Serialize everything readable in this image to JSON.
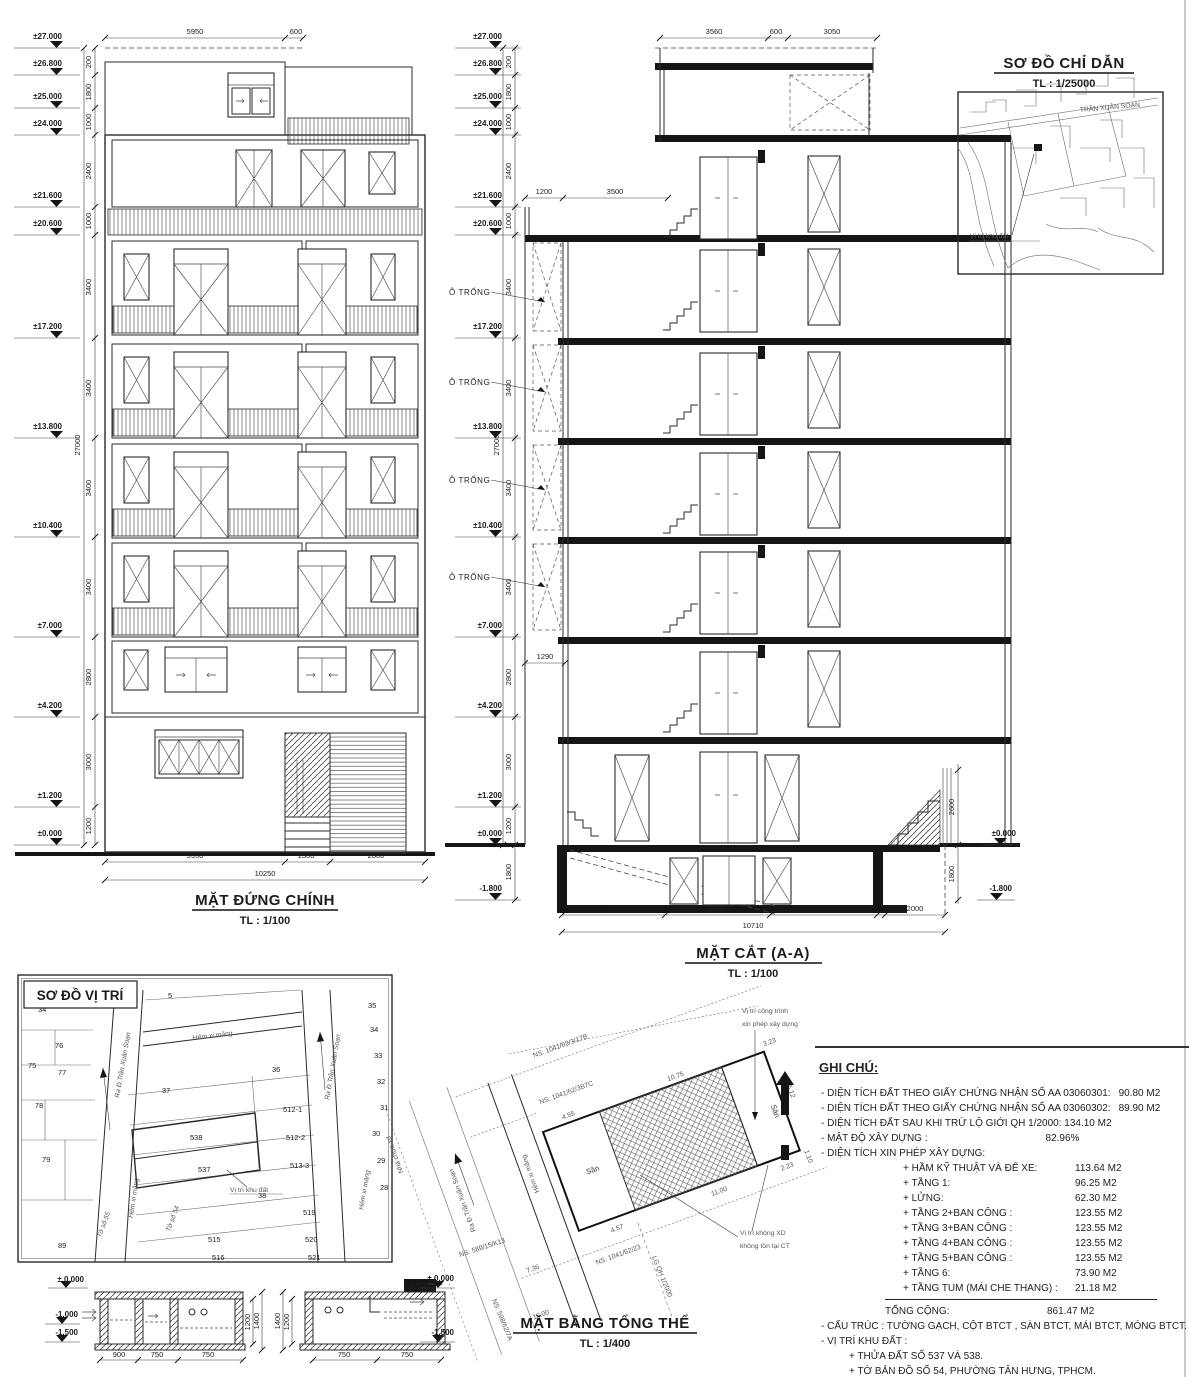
{
  "elevation": {
    "title": "MẶT ĐỨNG CHÍNH",
    "scale": "TL : 1/100",
    "levels": [
      "±27.000",
      "±26.800",
      "±25.000",
      "±24.000",
      "±21.600",
      "±20.600",
      "±17.200",
      "±13.800",
      "±10.400",
      "±7.000",
      "±4.200",
      "±1.200",
      "±0.000"
    ],
    "vdims": [
      "200",
      "1800",
      "1000",
      "2400",
      "1000",
      "3400",
      "3400",
      "3400",
      "3400",
      "2800",
      "3000",
      "1200"
    ],
    "total_vdim": "27000",
    "top_dims": [
      "5950",
      "600"
    ],
    "bottom_dims": [
      "5950",
      "1500",
      "2800"
    ],
    "bottom_total": "10250"
  },
  "section": {
    "title": "MẶT CẮT (A-A)",
    "scale": "TL : 1/100",
    "levels": [
      "±27.000",
      "±26.800",
      "±25.000",
      "±24.000",
      "±21.600",
      "±20.600",
      "±17.200",
      "±13.800",
      "±10.400",
      "±7.000",
      "±4.200",
      "±1.200",
      "±0.000"
    ],
    "below_level": "-1.800",
    "vdims": [
      "200",
      "1800",
      "1000",
      "2400",
      "1000",
      "3400",
      "3400",
      "3400",
      "3400",
      "2800",
      "3000",
      "1200"
    ],
    "vdim_below": "1800",
    "total_vdim": "27000",
    "void_label": "Ô TRỐNG",
    "top_dims": [
      "3560",
      "600",
      "3050"
    ],
    "mid_dims": [
      "1200",
      "3500"
    ],
    "balcony_dim": "1290",
    "bottom_dims": [
      "3500",
      "3560",
      "3650",
      "2000"
    ],
    "bottom_total": "10710",
    "right_dims": [
      "2600",
      "1800"
    ],
    "right_upper_level": "±0.000",
    "right_lower_level": "-1.800"
  },
  "index_map": {
    "title": "SƠ ĐỒ CHỈ DẪN",
    "scale": "TL : 1/25000",
    "street": "TRẦN XUÂN SOẠN",
    "site_label": "Vị trí khu đất"
  },
  "location_plan": {
    "title": "SƠ ĐỒ VỊ TRÍ",
    "street_top": "Hẻm xi măng",
    "street_left": "Ra Đ.Trần Xuân Soạn",
    "street_right": "Ra Đ.Trần Xuân Soạn",
    "alley_left": "Hẻm xi măng",
    "alley_right": "Hẻm xi măng",
    "sheet_left": "Tờ số 55",
    "sheet_bottom": "Tờ số 54",
    "site_label": "Vị trí khu đất",
    "parcels": [
      "5",
      "34",
      "76",
      "75",
      "77",
      "78",
      "79",
      "89",
      "36",
      "37",
      "538",
      "537",
      "512-1",
      "512-2",
      "513-3",
      "38",
      "515",
      "516",
      "519",
      "520",
      "521",
      "35",
      "34",
      "33",
      "32",
      "31",
      "30",
      "29",
      "28"
    ]
  },
  "site_plan": {
    "title": "MẶT BẰNG TỔNG THỂ",
    "scale": "TL : 1/400",
    "callout_build_1": "Vị trí công trình",
    "callout_build_2": "xin phép xây dựng",
    "callout_nobuild_1": "Vị trí không XD",
    "callout_nobuild_2": "không tồn tại CT",
    "yard": "Sân",
    "yard2": "Sân",
    "street": "Ra Đ.Trần Xuân Soạn",
    "alley": "Hẻm xi măng",
    "unbuilt": "Nhà chưa xd",
    "ns1": "NS: 1041/62/3/17B",
    "ns2": "NS: 1041/62/3B7C",
    "ns3": "NS: 1041/62/23",
    "ns4": "NS: 589/15/K13",
    "ns5": "NS: 598/62/7A",
    "lg_line": "LG QH 1/2000",
    "dims": {
      "top_left": "4.55",
      "top": "10.75",
      "top_right": "3.23",
      "right": "5.12",
      "bottom": "11.00",
      "bottom_left": "4.57",
      "bottom_right": "2.23",
      "street_w": "7.36",
      "street_l": "16.00",
      "edge": "1.10"
    },
    "datum": "0.000"
  },
  "details": {
    "left": {
      "lv_top": "± 0.000",
      "lv_mid": "-1.000",
      "lv_bot": "-1.500",
      "dims": [
        "900",
        "750",
        "750"
      ],
      "vdims": [
        "1200",
        "1400"
      ]
    },
    "right": {
      "lv_top": "± 0.000",
      "lv_bot": "-1.500",
      "dims": [
        "750",
        "750"
      ],
      "vdims": [
        "1400",
        "1200"
      ]
    }
  },
  "notes": {
    "title": "GHI CHÚ:",
    "rows": [
      {
        "label": "- DIỆN TÍCH ĐẤT THEO GIẤY CHỨNG NHẬN SỐ AA 03060301:",
        "value": "90.80 M2"
      },
      {
        "label": "- DIỆN TÍCH ĐẤT THEO GIẤY CHỨNG NHẬN SỐ AA 03060302:",
        "value": "89.90 M2"
      },
      {
        "label": "- DIỆN TÍCH ĐẤT SAU KHI TRỪ LỘ GIỚI QH 1/2000: 134.10 M2",
        "value": ""
      },
      {
        "label": "- MẬT ĐỘ XÂY DỰNG :",
        "value": "82.96%"
      },
      {
        "label": "- DIỆN TÍCH XIN PHÉP XÂY DỰNG:",
        "value": ""
      }
    ],
    "areas": [
      {
        "label": "+ HẦM KỸ THUẬT VÀ ĐỂ XE:",
        "value": "113.64 M2"
      },
      {
        "label": "+ TẦNG 1:",
        "value": "96.25 M2"
      },
      {
        "label": "+ LỬNG:",
        "value": "62.30 M2"
      },
      {
        "label": "+ TẦNG 2+BAN CÔNG :",
        "value": "123.55 M2"
      },
      {
        "label": "+ TẦNG 3+BAN CÔNG :",
        "value": "123.55 M2"
      },
      {
        "label": "+ TẦNG 4+BAN CÔNG :",
        "value": "123.55 M2"
      },
      {
        "label": "+ TẦNG 5+BAN CÔNG :",
        "value": "123.55 M2"
      },
      {
        "label": "+ TẦNG 6:",
        "value": "73.90 M2"
      },
      {
        "label": "+ TẦNG TUM (MÁI CHE THANG) :",
        "value": "21.18 M2"
      }
    ],
    "total_label": "TỔNG CỘNG:",
    "total_value": "861.47 M2",
    "footer": [
      "- CẤU TRÚC : TƯỜNG GẠCH, CỘT BTCT , SÀN BTCT, MÁI BTCT, MÓNG BTCT.",
      "- VỊ TRÍ KHU ĐẤT :",
      "+ THỬA ĐẤT SỐ 537 VÀ 538.",
      "+ TỜ BẢN ĐỒ SỐ 54, PHƯỜNG TÂN HƯNG, TPHCM.",
      "- CỐT ± 0.000 LẤY THEO CAO ĐỘ ĐỈNH ĐƯỜNG HẺM PHÍA TRƯỚC CÔNG TRÌNH"
    ]
  }
}
